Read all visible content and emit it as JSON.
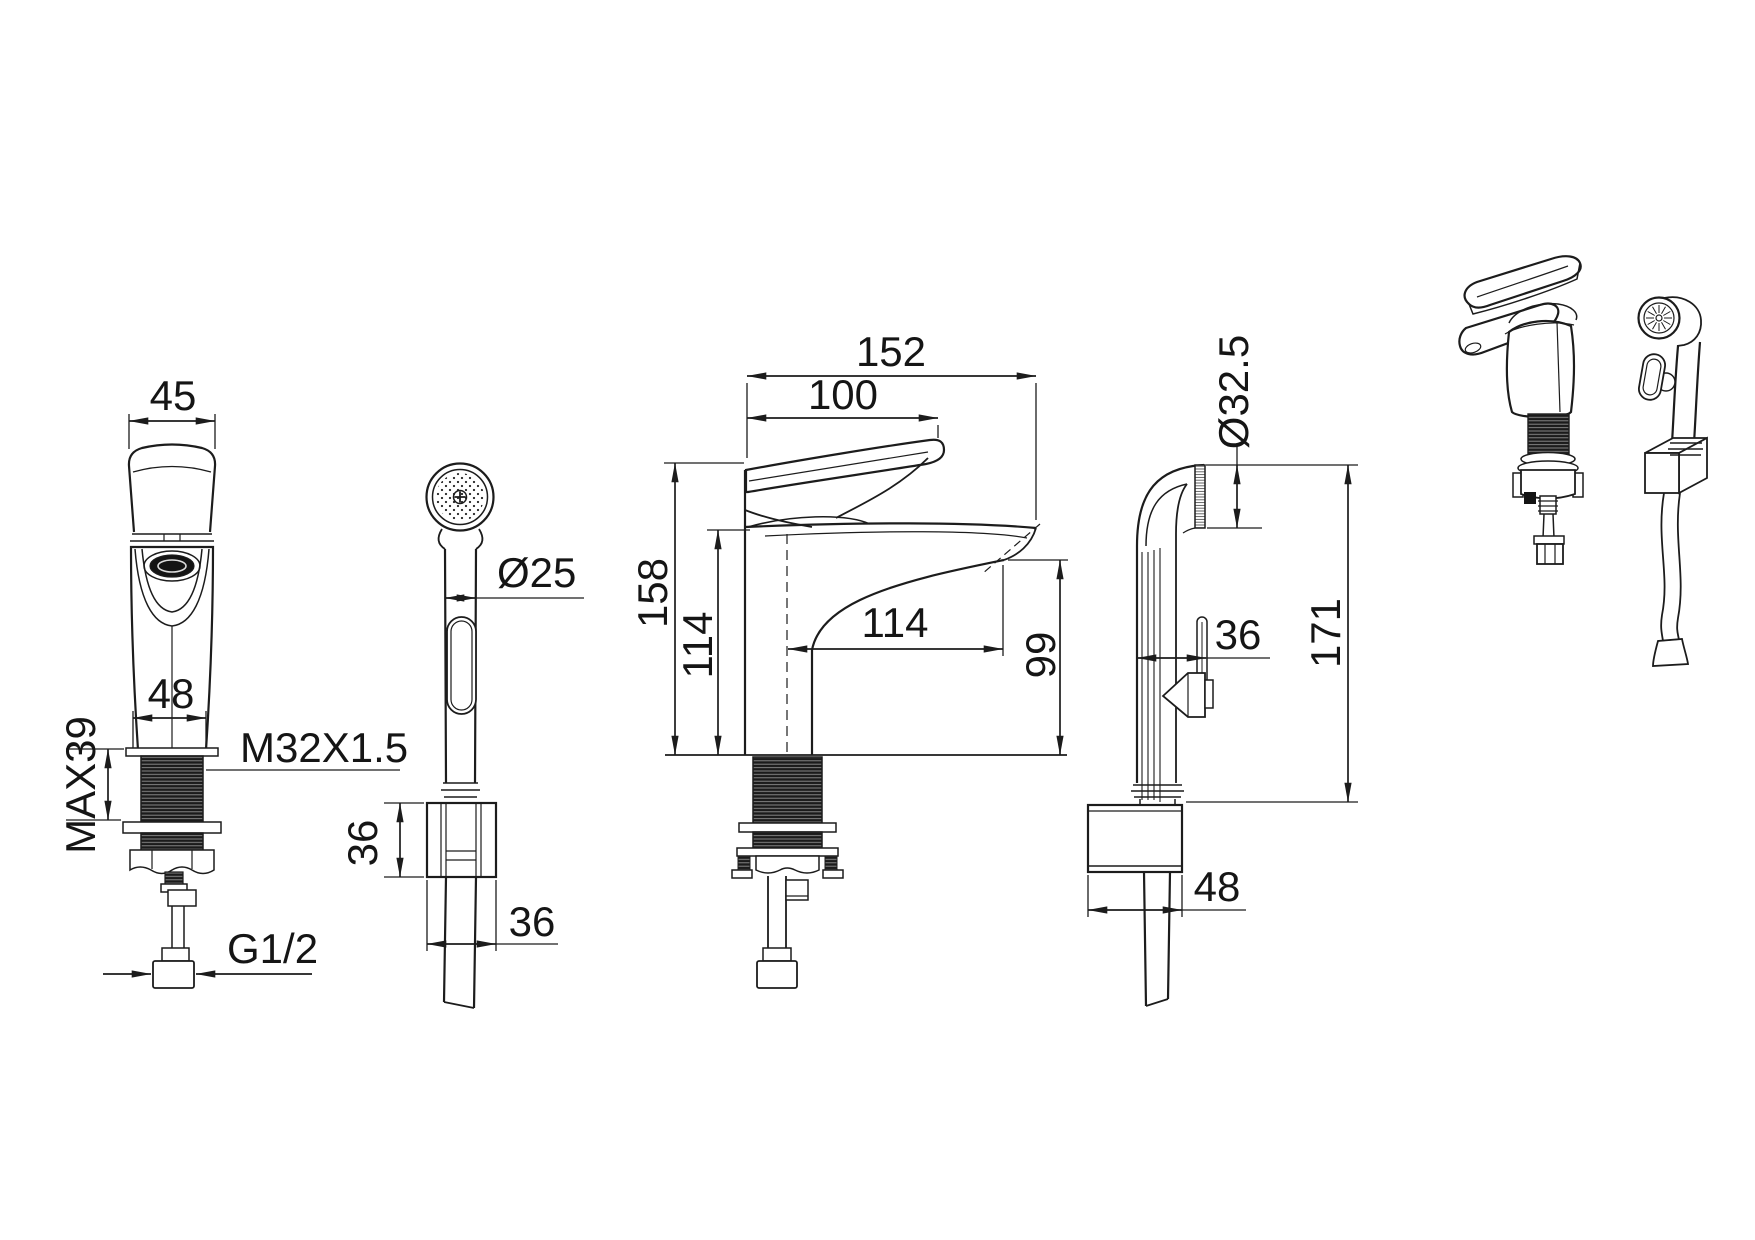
{
  "drawing": {
    "background": "#ffffff",
    "ink": "#1c1c1c",
    "views": {
      "faucet_front": {
        "dims": {
          "handle_width": "45",
          "body_width": "48",
          "max_thread": "MAX39",
          "thread_spec": "M32X1.5",
          "inlet": "G1/2"
        }
      },
      "sprayer_side": {
        "dims": {
          "grip_diameter": "Ø25",
          "bracket_height": "36",
          "bracket_width": "36"
        }
      },
      "faucet_side": {
        "dims": {
          "total_depth": "152",
          "handle_depth": "100",
          "total_height": "158",
          "deck_height": "114",
          "spout_reach": "114",
          "outlet_height": "99"
        }
      },
      "sprayer_holder": {
        "dims": {
          "head_diameter": "Ø32.5",
          "body_offset": "36",
          "total_height": "171",
          "base_width": "48"
        }
      }
    }
  }
}
